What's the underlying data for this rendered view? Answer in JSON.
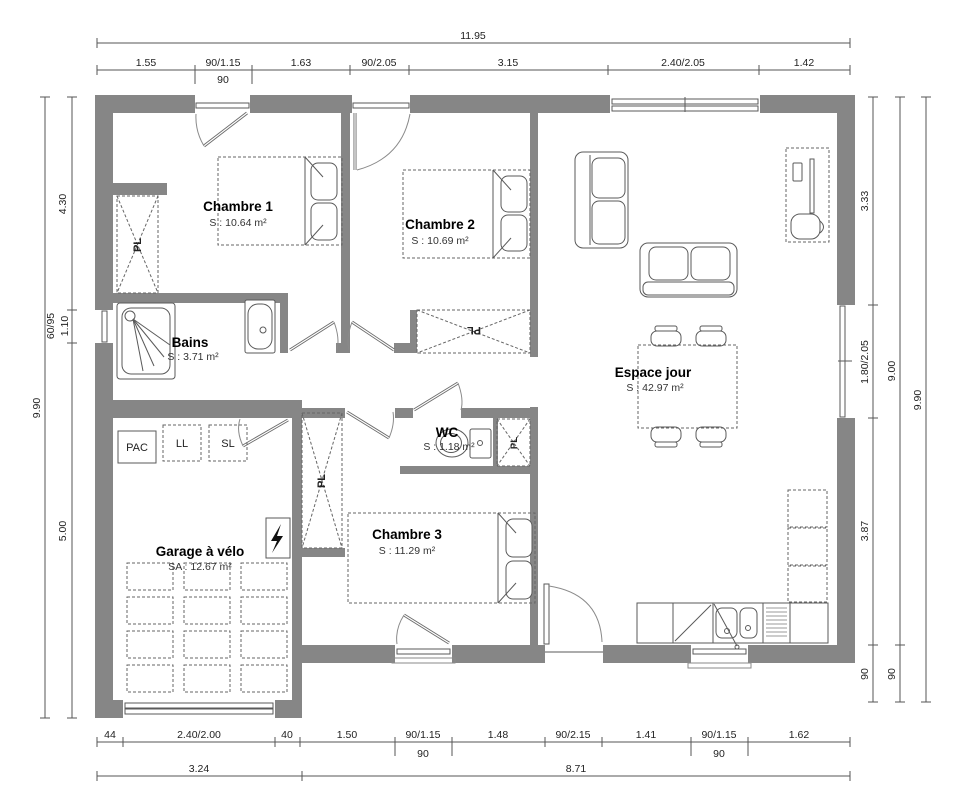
{
  "plan": {
    "rooms": {
      "chambre1": {
        "name": "Chambre 1",
        "area": "S : 10.64 m²"
      },
      "chambre2": {
        "name": "Chambre 2",
        "area": "S : 10.69 m²"
      },
      "chambre3": {
        "name": "Chambre 3",
        "area": "S : 11.29 m²"
      },
      "bains": {
        "name": "Bains",
        "area": "S : 3.71 m²"
      },
      "wc": {
        "name": "WC",
        "area": "S : 1.18 m²"
      },
      "espace_jour": {
        "name": "Espace jour",
        "area": "S : 42.97 m²"
      },
      "garage": {
        "name": "Garage à vélo",
        "area": "SA : 12.67 m²"
      }
    },
    "closet": {
      "label": "PL"
    },
    "equipment": {
      "pac": "PAC",
      "ll": "LL",
      "sl": "SL"
    },
    "colors": {
      "wall": "#868686",
      "line": "#5a5a5a",
      "text": "#000000"
    }
  },
  "dims": {
    "top": {
      "total": "11.95",
      "segments": [
        "1.55",
        "90/1.15",
        "1.63",
        "90/2.05",
        "3.15",
        "2.40/2.05",
        "1.42"
      ],
      "sub": "90"
    },
    "bottom": {
      "segments": [
        "44",
        "2.40/2.00",
        "40",
        "1.50",
        "90/1.15",
        "1.48",
        "90/2.15",
        "1.41",
        "90/1.15",
        "1.62"
      ],
      "subs": [
        "90",
        "90"
      ],
      "totals": [
        "3.24",
        "8.71"
      ]
    },
    "left": {
      "total": "9.90",
      "segments": [
        "4.30",
        "60/95",
        "1.10",
        "5.00"
      ]
    },
    "right": {
      "total": "9.90",
      "segments": [
        "3.33",
        "1.80/2.05",
        "3.87",
        "90"
      ],
      "middle": [
        "9.00",
        "90"
      ]
    }
  }
}
